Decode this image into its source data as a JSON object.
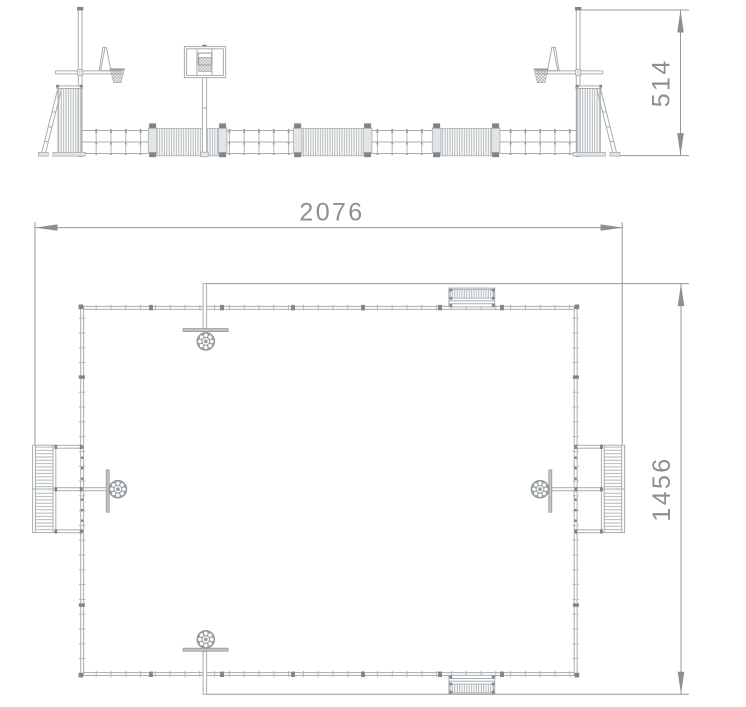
{
  "dimensions": {
    "elevation_height": "514",
    "plan_width": "2076",
    "plan_depth": "1456"
  },
  "colors": {
    "line": "#a8adb1",
    "mid": "#94999d",
    "dark": "#7f8488",
    "text": "#8a9094",
    "fill": "#e2e4e6",
    "bg": "#ffffff",
    "ball": "#9aa0a4"
  }
}
